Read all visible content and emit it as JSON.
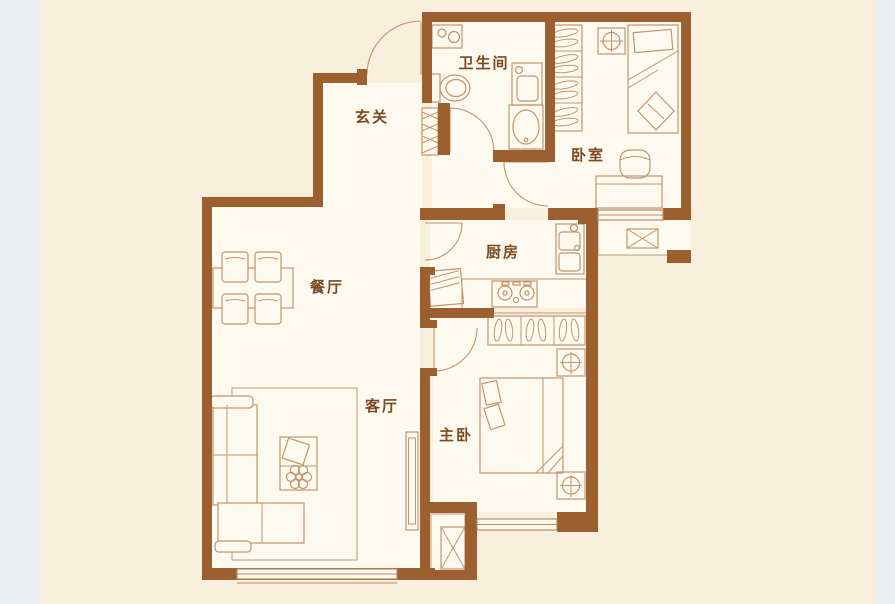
{
  "colors": {
    "page": "#edeff3",
    "canvas": "#f9efdd",
    "room": "#fffaf0",
    "wall": "#9c6030",
    "furn": "#c2946c",
    "winline": "#b98a5f",
    "label": "#7a4a22"
  },
  "floor_plan": {
    "rooms": [
      {
        "label": "玄关",
        "furniture": [
          "entry-door",
          "shoe-cabinet"
        ]
      },
      {
        "label": "卫生间",
        "furniture": [
          "washing-machine",
          "toilet",
          "vanity-cabinet",
          "wash-basin",
          "door"
        ]
      },
      {
        "label": "卧室",
        "furniture": [
          "wardrobe",
          "nightstand-lamp",
          "single-bed",
          "desk",
          "chair",
          "window",
          "door"
        ]
      },
      {
        "label": "厨房",
        "furniture": [
          "refrigerator",
          "counter",
          "stove",
          "sink",
          "door"
        ]
      },
      {
        "label": "餐厅",
        "furniture": [
          "dining-table",
          "chair",
          "chair",
          "chair",
          "chair"
        ]
      },
      {
        "label": "客厅",
        "furniture": [
          "sectional-sofa",
          "rug",
          "coffee-table",
          "plant",
          "tv-cabinet",
          "window"
        ]
      },
      {
        "label": "主卧",
        "furniture": [
          "wardrobe",
          "double-bed",
          "nightstand-lamp",
          "nightstand-lamp",
          "window",
          "door"
        ]
      }
    ],
    "equipment_platforms": [
      {
        "icon": "crossed-box"
      },
      {
        "icon": "crossed-box"
      }
    ]
  }
}
